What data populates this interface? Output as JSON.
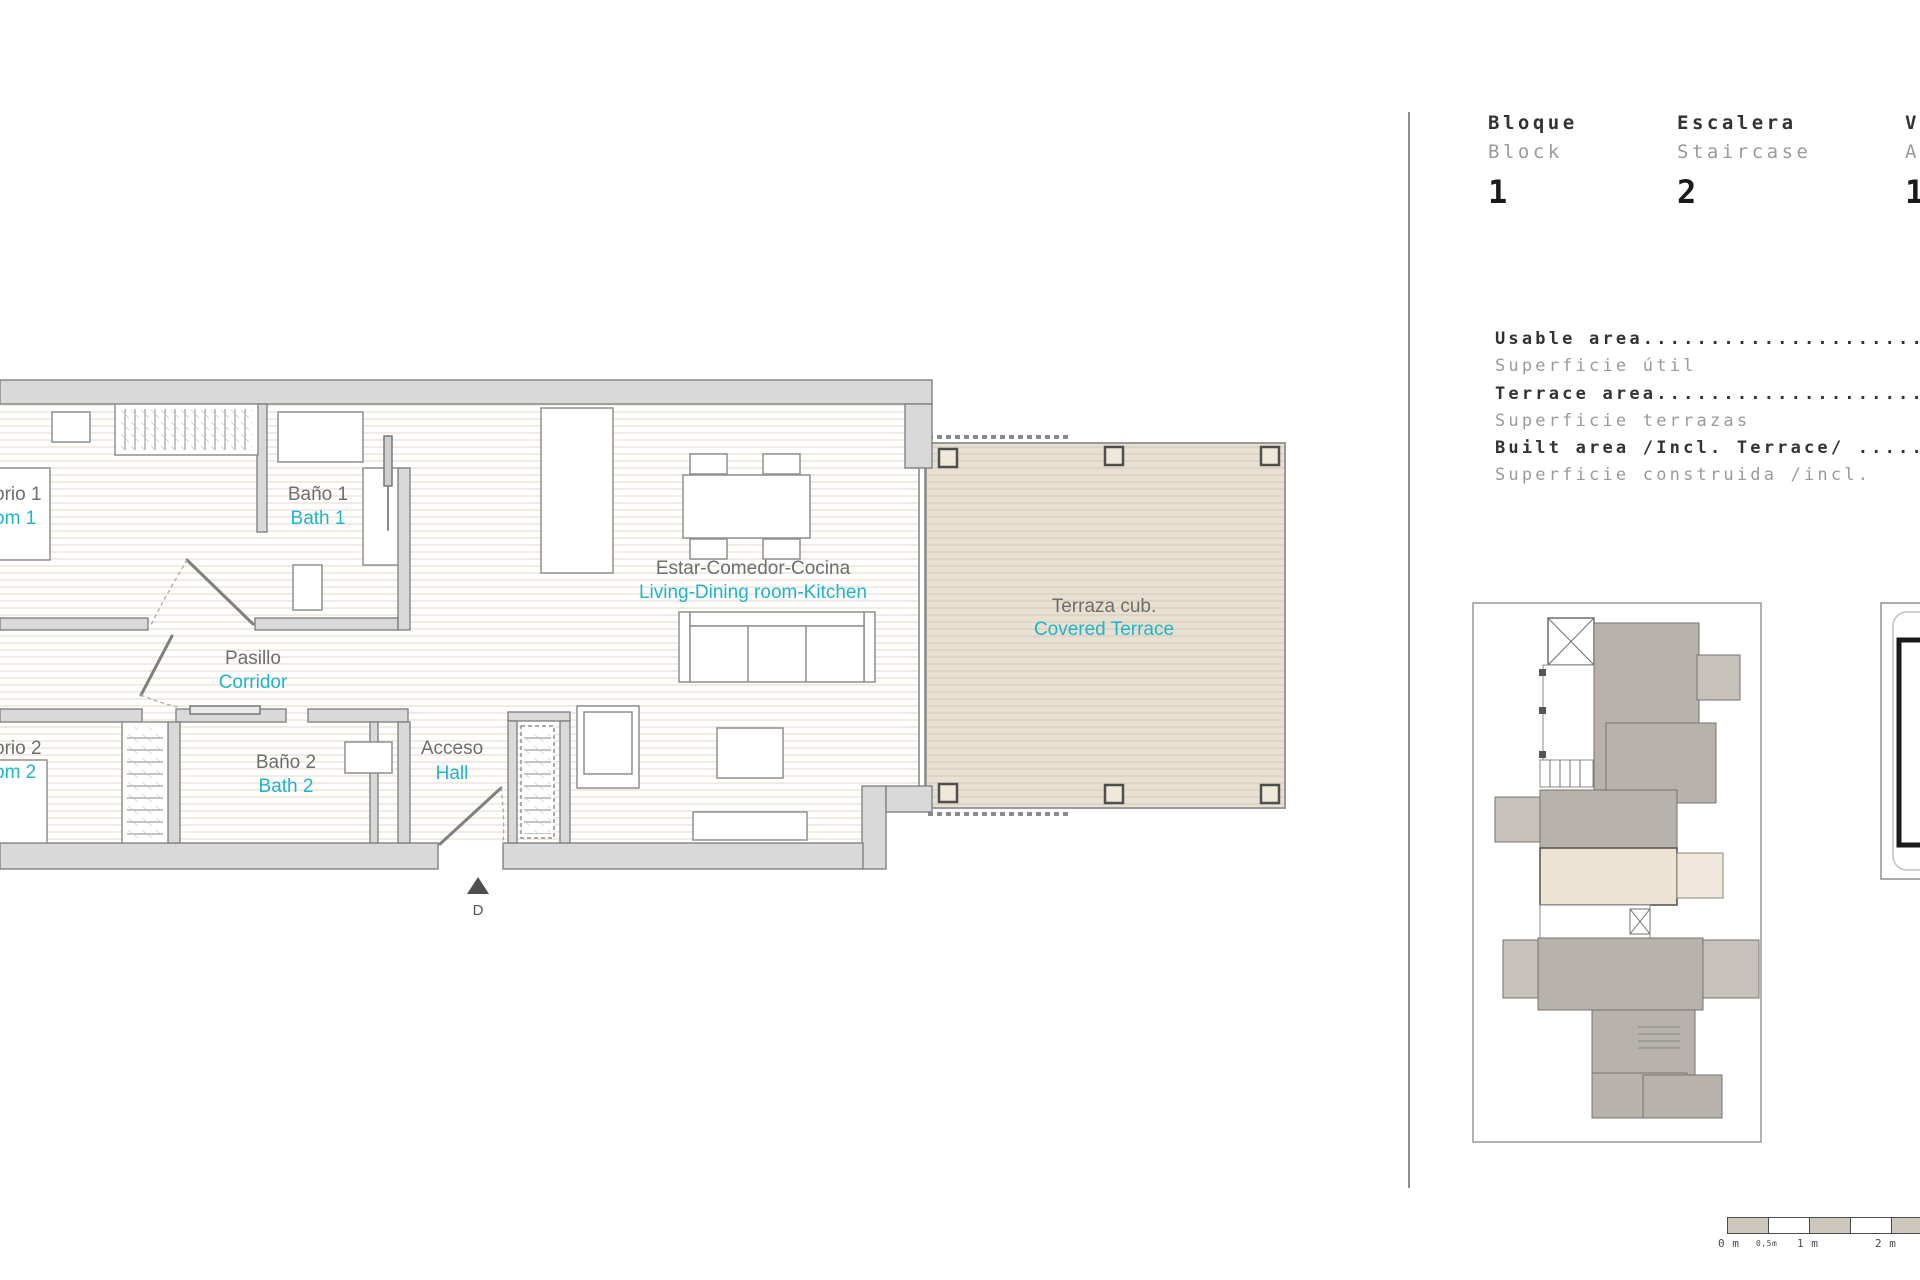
{
  "plan": {
    "labels": {
      "bedroom1_es": "orio 1",
      "bedroom1_en": "om 1",
      "bath1_es": "Baño 1",
      "bath1_en": "Bath 1",
      "corridor_es": "Pasillo",
      "corridor_en": "Corridor",
      "bedroom2_es": "orio 2",
      "bedroom2_en": "om 2",
      "bath2_es": "Baño 2",
      "bath2_en": "Bath 2",
      "hall_es": "Acceso",
      "hall_en": "Hall",
      "living_es": "Estar-Comedor-Cocina",
      "living_en": "Living-Dining room-Kitchen",
      "terrace_es": "Terraza cub.",
      "terrace_en": "Covered Terrace",
      "door_marker": "D"
    },
    "colors": {
      "accent_cyan": "#1fb5c9",
      "label_gray": "#6e6e6e",
      "wall_fill": "#d9d9d9",
      "terrace_fill": "#e8e1d3"
    }
  },
  "info_panel": {
    "columns": [
      {
        "label_es": "Bloque",
        "label_en": "Block",
        "value": "1"
      },
      {
        "label_es": "Escalera",
        "label_en": "Staircase",
        "value": "2"
      },
      {
        "label_es": "V",
        "label_en": "A",
        "value": "1"
      }
    ],
    "areas": [
      {
        "label_en": "Usable area...............................",
        "label_es": "Superficie útil"
      },
      {
        "label_en": "Terrace area..............................",
        "label_es": "Superficie terrazas"
      },
      {
        "label_en": "Built area /Incl. Terrace/ ...............",
        "label_es": "Superficie construida /incl. "
      }
    ]
  },
  "scale_bar": {
    "labels": [
      "0 m",
      "0,5m",
      "1 m",
      "2 m"
    ]
  }
}
